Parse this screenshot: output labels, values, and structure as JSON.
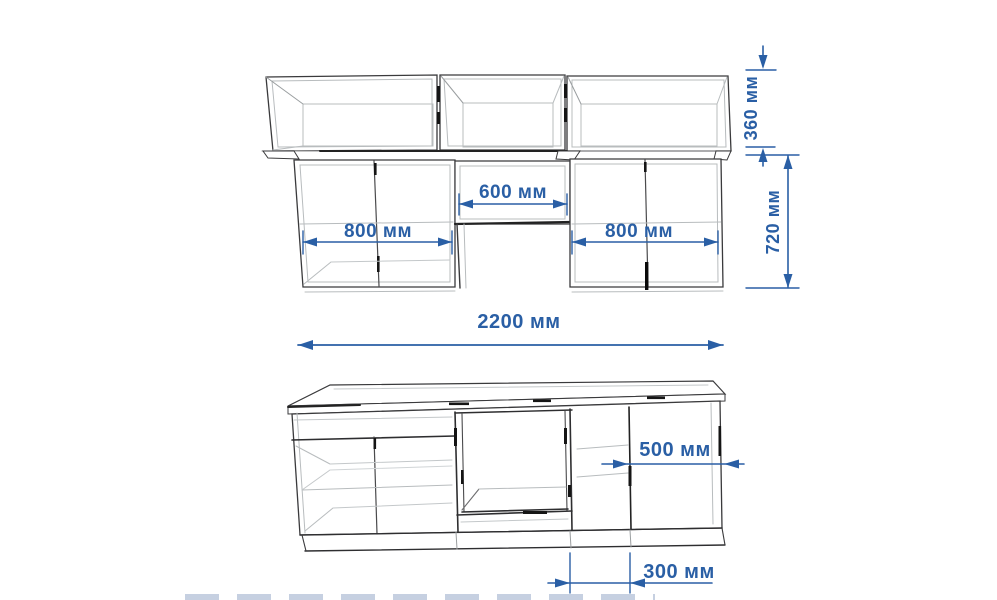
{
  "page": {
    "background": "#ffffff",
    "description": "Dimensioned wireframe drawing of a kitchen cabinet set: front elevation with wall cabinets above and a perspective view of the base cabinet unit below"
  },
  "colors": {
    "dimension_blue": "#2a5fa5",
    "line_dark": "#3a3a3c",
    "line_medium": "#6d6d6f",
    "line_light": "#b8bcbe",
    "line_black": "#151515"
  },
  "drawing": {
    "views": {
      "elevation": {
        "name": "front elevation with wall cabinets",
        "dims": {
          "left_width": {
            "value": 800,
            "unit": "мм",
            "label": "800 мм"
          },
          "middle_width": {
            "value": 600,
            "unit": "мм",
            "label": "600 мм"
          },
          "right_width": {
            "value": 800,
            "unit": "мм",
            "label": "800 мм"
          },
          "upper_height": {
            "value": 360,
            "unit": "мм",
            "label": "360 мм"
          },
          "lower_height": {
            "value": 720,
            "unit": "мм",
            "label": "720 мм"
          },
          "total_width": {
            "value": 2200,
            "unit": "мм",
            "label": "2200 мм"
          }
        }
      },
      "base": {
        "name": "base cabinet unit perspective",
        "dims": {
          "right_cabinet_width": {
            "value": 500,
            "unit": "мм",
            "label": "500 мм"
          },
          "plinth_offset": {
            "value": 300,
            "unit": "мм",
            "label": "300 мм"
          }
        }
      }
    }
  }
}
